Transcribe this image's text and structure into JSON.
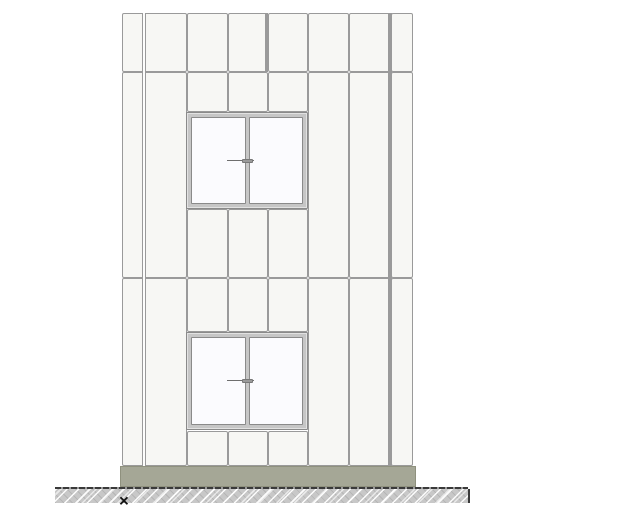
{
  "drawing": {
    "kind": "architectural-elevation",
    "canvas": {
      "width": 640,
      "height": 508
    }
  },
  "colors": {
    "background": "#ffffff",
    "panel_fill": "#f7f7f4",
    "joint_line": "#9a9a9a",
    "window_frame_face": "#c6c6c6",
    "window_frame_line": "#8a8a8a",
    "glass": "#fbfbfe",
    "base_fill": "#a5a796",
    "base_line": "#8f917e",
    "ground_fill": "#c8c8c8",
    "grade_line": "#3a3a3a",
    "marker": "#111111"
  },
  "facade": {
    "outline": {
      "x": 122,
      "y": 13,
      "w": 291,
      "h": 453
    },
    "panels": [
      {
        "x": 122,
        "y": 13,
        "w": 22,
        "h": 59
      },
      {
        "x": 144,
        "y": 13,
        "w": 43,
        "h": 59
      },
      {
        "x": 187,
        "y": 13,
        "w": 41,
        "h": 59
      },
      {
        "x": 228,
        "y": 13,
        "w": 40,
        "h": 59
      },
      {
        "x": 268,
        "y": 13,
        "w": 40,
        "h": 59
      },
      {
        "x": 308,
        "y": 13,
        "w": 41,
        "h": 59
      },
      {
        "x": 349,
        "y": 13,
        "w": 42,
        "h": 59
      },
      {
        "x": 391,
        "y": 13,
        "w": 22,
        "h": 59
      },
      {
        "x": 122,
        "y": 72,
        "w": 22,
        "h": 206
      },
      {
        "x": 144,
        "y": 72,
        "w": 43,
        "h": 206
      },
      {
        "x": 308,
        "y": 72,
        "w": 41,
        "h": 206
      },
      {
        "x": 349,
        "y": 72,
        "w": 42,
        "h": 206
      },
      {
        "x": 391,
        "y": 72,
        "w": 22,
        "h": 206
      },
      {
        "x": 187,
        "y": 72,
        "w": 41,
        "h": 40
      },
      {
        "x": 228,
        "y": 72,
        "w": 40,
        "h": 40
      },
      {
        "x": 268,
        "y": 72,
        "w": 40,
        "h": 40
      },
      {
        "x": 187,
        "y": 209,
        "w": 41,
        "h": 69
      },
      {
        "x": 228,
        "y": 209,
        "w": 40,
        "h": 69
      },
      {
        "x": 268,
        "y": 209,
        "w": 40,
        "h": 69
      },
      {
        "x": 122,
        "y": 278,
        "w": 22,
        "h": 188
      },
      {
        "x": 144,
        "y": 278,
        "w": 43,
        "h": 188
      },
      {
        "x": 308,
        "y": 278,
        "w": 41,
        "h": 188
      },
      {
        "x": 349,
        "y": 278,
        "w": 42,
        "h": 188
      },
      {
        "x": 391,
        "y": 278,
        "w": 22,
        "h": 188
      },
      {
        "x": 187,
        "y": 278,
        "w": 41,
        "h": 54
      },
      {
        "x": 228,
        "y": 278,
        "w": 40,
        "h": 54
      },
      {
        "x": 268,
        "y": 278,
        "w": 40,
        "h": 54
      },
      {
        "x": 187,
        "y": 431,
        "w": 41,
        "h": 35
      },
      {
        "x": 228,
        "y": 431,
        "w": 40,
        "h": 35
      },
      {
        "x": 268,
        "y": 431,
        "w": 40,
        "h": 35
      }
    ],
    "joint_overlays": [
      {
        "type": "double",
        "x": 142,
        "y": 13,
        "w": 4,
        "h": 453
      },
      {
        "type": "thick",
        "x": 388,
        "y": 13,
        "w": 4,
        "h": 453
      },
      {
        "type": "thick",
        "x": 265,
        "y": 13,
        "w": 3,
        "h": 59
      }
    ]
  },
  "windows": [
    {
      "name": "upper-window",
      "x": 186,
      "y": 112,
      "w": 122,
      "h": 97,
      "panes": 2
    },
    {
      "name": "lower-window",
      "x": 186,
      "y": 332,
      "w": 122,
      "h": 98,
      "panes": 2
    }
  ],
  "base": {
    "x": 120,
    "y": 466,
    "w": 296,
    "h": 21
  },
  "ground": {
    "x": 55,
    "y": 489,
    "w": 413,
    "h": 14
  },
  "grade_line": {
    "x": 55,
    "y": 487,
    "w": 413,
    "h": 2
  },
  "origin_marker": {
    "x": 124,
    "y": 501,
    "glyph": "✕"
  }
}
